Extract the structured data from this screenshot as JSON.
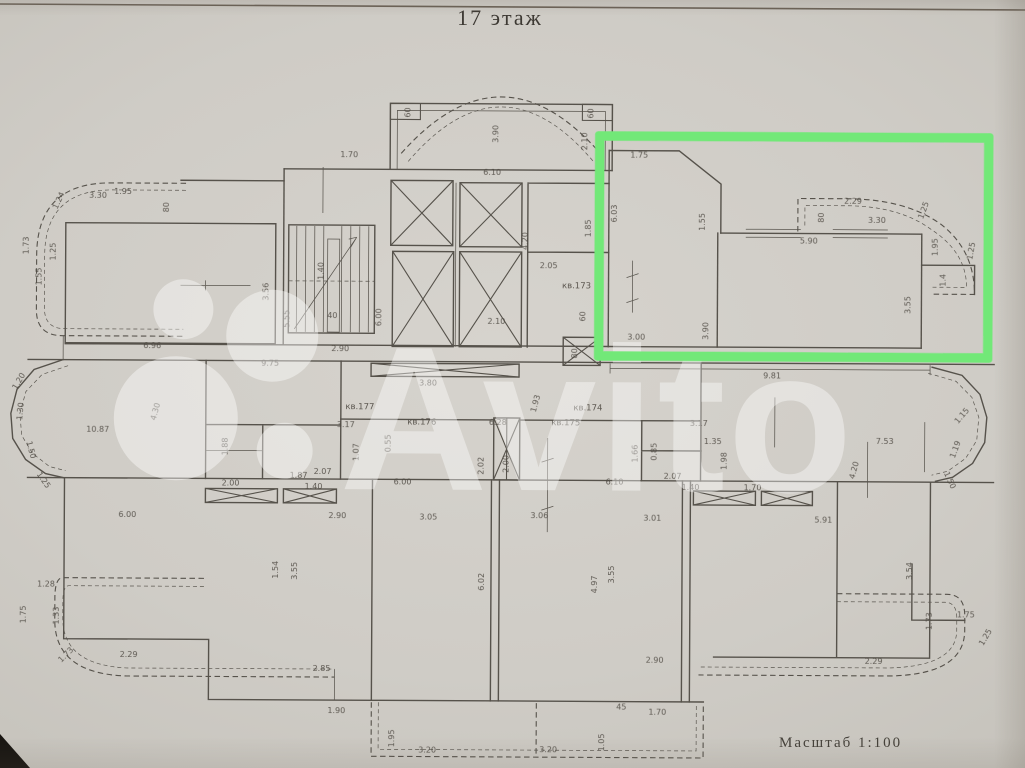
{
  "document": {
    "title": "17 этаж",
    "scale_label": "Масштаб  1:100"
  },
  "watermark": {
    "text": "Avito"
  },
  "highlight": {
    "color": "#72e878",
    "note_color_name": "green"
  },
  "plan": {
    "apartment_labels": [
      {
        "t": "кв.173",
        "x": 576,
        "y": 288
      },
      {
        "t": "кв.177",
        "x": 360,
        "y": 410
      },
      {
        "t": "кв.176",
        "x": 422,
        "y": 425
      },
      {
        "t": "кв.175",
        "x": 566,
        "y": 425
      },
      {
        "t": "кв.174",
        "x": 588,
        "y": 410
      }
    ],
    "dimension_labels": [
      {
        "t": "1.70",
        "x": 348,
        "y": 158
      },
      {
        "t": "60",
        "x": 409,
        "y": 113,
        "r": -90
      },
      {
        "t": "3.90",
        "x": 497,
        "y": 134,
        "r": -90
      },
      {
        "t": "60",
        "x": 592,
        "y": 113,
        "r": -90
      },
      {
        "t": "2.10",
        "x": 586,
        "y": 141,
        "r": -90
      },
      {
        "t": "6.10",
        "x": 491,
        "y": 175
      },
      {
        "t": "1.75",
        "x": 638,
        "y": 157
      },
      {
        "t": "6.03",
        "x": 616,
        "y": 213,
        "r": -90
      },
      {
        "t": "1.55",
        "x": 704,
        "y": 221,
        "r": -90
      },
      {
        "t": "1.85",
        "x": 590,
        "y": 228,
        "r": -90
      },
      {
        "t": "3.00",
        "x": 636,
        "y": 339
      },
      {
        "t": "3.90",
        "x": 708,
        "y": 330,
        "r": -90
      },
      {
        "t": "5.90",
        "x": 808,
        "y": 242
      },
      {
        "t": "2.29",
        "x": 852,
        "y": 202
      },
      {
        "t": "80",
        "x": 823,
        "y": 216,
        "r": -90
      },
      {
        "t": "3.30",
        "x": 876,
        "y": 221
      },
      {
        "t": "1.25",
        "x": 925,
        "y": 209,
        "r": -70
      },
      {
        "t": "1.95",
        "x": 937,
        "y": 245,
        "r": -90
      },
      {
        "t": "1.4",
        "x": 945,
        "y": 278,
        "r": -90
      },
      {
        "t": "1.25",
        "x": 973,
        "y": 249,
        "r": -80
      },
      {
        "t": "3.55",
        "x": 910,
        "y": 303,
        "r": -90
      },
      {
        "t": "9.81",
        "x": 772,
        "y": 377
      },
      {
        "t": "2.05",
        "x": 548,
        "y": 268
      },
      {
        "t": "4.20",
        "x": 527,
        "y": 241,
        "r": -90
      },
      {
        "t": "2.10",
        "x": 496,
        "y": 324
      },
      {
        "t": "60",
        "x": 585,
        "y": 316,
        "r": -90
      },
      {
        "t": "80",
        "x": 577,
        "y": 353,
        "r": -90
      },
      {
        "t": "3.30",
        "x": 97,
        "y": 200
      },
      {
        "t": "1.24",
        "x": 60,
        "y": 204,
        "r": -65
      },
      {
        "t": "1.95",
        "x": 122,
        "y": 196
      },
      {
        "t": "80",
        "x": 168,
        "y": 209,
        "r": -90
      },
      {
        "t": "1.73",
        "x": 28,
        "y": 248,
        "r": -90
      },
      {
        "t": "1.25",
        "x": 55,
        "y": 254,
        "r": -90
      },
      {
        "t": "1.55",
        "x": 41,
        "y": 279,
        "r": -90
      },
      {
        "t": "3.56",
        "x": 268,
        "y": 293,
        "r": -90
      },
      {
        "t": "6.96",
        "x": 152,
        "y": 350
      },
      {
        "t": "9.75",
        "x": 270,
        "y": 367
      },
      {
        "t": "5.55",
        "x": 289,
        "y": 320,
        "r": -90
      },
      {
        "t": "1.40",
        "x": 323,
        "y": 272,
        "r": -90
      },
      {
        "t": "40",
        "x": 332,
        "y": 319
      },
      {
        "t": "6.00",
        "x": 381,
        "y": 318,
        "r": -90
      },
      {
        "t": "2.90",
        "x": 340,
        "y": 352
      },
      {
        "t": "3.80",
        "x": 428,
        "y": 386
      },
      {
        "t": "1.93",
        "x": 538,
        "y": 404,
        "r": -75
      },
      {
        "t": "10.87",
        "x": 98,
        "y": 434
      },
      {
        "t": "4.30",
        "x": 158,
        "y": 414,
        "r": -75
      },
      {
        "t": "1.20",
        "x": 21,
        "y": 385,
        "r": -60
      },
      {
        "t": "1.30",
        "x": 23,
        "y": 414,
        "r": -85
      },
      {
        "t": "1.50",
        "x": 29,
        "y": 453,
        "r": 75
      },
      {
        "t": "1.25",
        "x": 42,
        "y": 484,
        "r": 55
      },
      {
        "t": "3.17",
        "x": 346,
        "y": 428
      },
      {
        "t": "1.88",
        "x": 228,
        "y": 448,
        "r": -90
      },
      {
        "t": "1.87",
        "x": 299,
        "y": 479
      },
      {
        "t": "0.55",
        "x": 391,
        "y": 444,
        "r": -90
      },
      {
        "t": "2.07",
        "x": 323,
        "y": 475
      },
      {
        "t": "1.07",
        "x": 359,
        "y": 453,
        "r": -90
      },
      {
        "t": "2.02",
        "x": 484,
        "y": 466,
        "r": -90
      },
      {
        "t": "2.00",
        "x": 509,
        "y": 464,
        "r": -90
      },
      {
        "t": "6.28",
        "x": 498,
        "y": 425
      },
      {
        "t": "3.17",
        "x": 699,
        "y": 425
      },
      {
        "t": "1.35",
        "x": 713,
        "y": 443
      },
      {
        "t": "1.66",
        "x": 638,
        "y": 453,
        "r": -90
      },
      {
        "t": "0.85",
        "x": 657,
        "y": 451,
        "r": -90
      },
      {
        "t": "2.07",
        "x": 673,
        "y": 478
      },
      {
        "t": "1.98",
        "x": 727,
        "y": 460,
        "r": -90
      },
      {
        "t": "1.40",
        "x": 691,
        "y": 489
      },
      {
        "t": "1.70",
        "x": 753,
        "y": 489
      },
      {
        "t": "7.53",
        "x": 885,
        "y": 442
      },
      {
        "t": "4.20",
        "x": 857,
        "y": 469,
        "r": -75
      },
      {
        "t": "1.15",
        "x": 964,
        "y": 415,
        "r": -50
      },
      {
        "t": "1.19",
        "x": 958,
        "y": 448,
        "r": -70
      },
      {
        "t": "1.50",
        "x": 948,
        "y": 479,
        "r": 65
      },
      {
        "t": "2.00",
        "x": 231,
        "y": 487
      },
      {
        "t": "1.40",
        "x": 314,
        "y": 490
      },
      {
        "t": "6.00",
        "x": 403,
        "y": 485
      },
      {
        "t": "6.10",
        "x": 615,
        "y": 484
      },
      {
        "t": "6.00",
        "x": 128,
        "y": 519
      },
      {
        "t": "2.90",
        "x": 338,
        "y": 519
      },
      {
        "t": "3.05",
        "x": 429,
        "y": 520
      },
      {
        "t": "3.06",
        "x": 540,
        "y": 518
      },
      {
        "t": "3.01",
        "x": 653,
        "y": 520
      },
      {
        "t": "5.91",
        "x": 824,
        "y": 521
      },
      {
        "t": "1.54",
        "x": 279,
        "y": 571,
        "r": -90
      },
      {
        "t": "3.55",
        "x": 298,
        "y": 572,
        "r": -90
      },
      {
        "t": "6.02",
        "x": 485,
        "y": 582,
        "r": -90
      },
      {
        "t": "4.97",
        "x": 598,
        "y": 584,
        "r": -90
      },
      {
        "t": "3.55",
        "x": 615,
        "y": 574,
        "r": -90
      },
      {
        "t": "3.54",
        "x": 913,
        "y": 569,
        "r": -90
      },
      {
        "t": "2.85",
        "x": 323,
        "y": 672
      },
      {
        "t": "1.90",
        "x": 338,
        "y": 714
      },
      {
        "t": "45",
        "x": 623,
        "y": 709
      },
      {
        "t": "1.70",
        "x": 659,
        "y": 714
      },
      {
        "t": "2.90",
        "x": 656,
        "y": 662
      },
      {
        "t": "1.95",
        "x": 396,
        "y": 739,
        "r": -90
      },
      {
        "t": "1.05",
        "x": 606,
        "y": 742,
        "r": -90
      },
      {
        "t": "3.20",
        "x": 429,
        "y": 753
      },
      {
        "t": "3.20",
        "x": 550,
        "y": 752
      },
      {
        "t": "1.28",
        "x": 47,
        "y": 589
      },
      {
        "t": "1.75",
        "x": 27,
        "y": 617,
        "r": -90
      },
      {
        "t": "1.33",
        "x": 60,
        "y": 618,
        "r": -90
      },
      {
        "t": "1.73",
        "x": 69,
        "y": 659,
        "r": -45
      },
      {
        "t": "2.29",
        "x": 130,
        "y": 659
      },
      {
        "t": "1.73",
        "x": 933,
        "y": 619,
        "r": -90
      },
      {
        "t": "1.75",
        "x": 967,
        "y": 615
      },
      {
        "t": "2.29",
        "x": 875,
        "y": 662
      },
      {
        "t": "1.25",
        "x": 989,
        "y": 636,
        "r": -60
      }
    ]
  }
}
